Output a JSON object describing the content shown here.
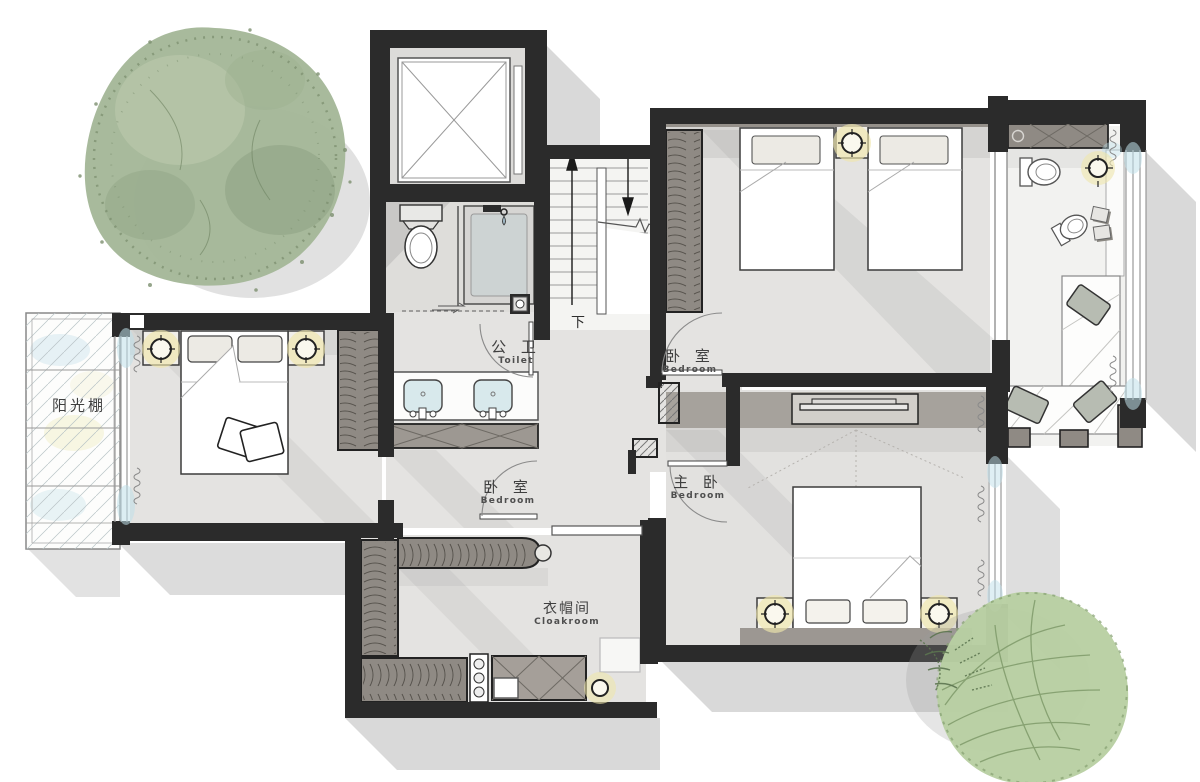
{
  "labels": {
    "sunroom": {
      "zh": "阳光棚"
    },
    "toilet": {
      "zh": "公 卫",
      "en": "Toilet"
    },
    "bedroom_top": {
      "zh": "卧 室",
      "en": "Bedroom"
    },
    "bedroom_left": {
      "zh": "卧 室",
      "en": "Bedroom"
    },
    "master_bedroom": {
      "zh": "主 卧",
      "en": "Bedroom"
    },
    "cloakroom": {
      "zh": "衣帽间",
      "en": "Cloakroom"
    },
    "stairs_down": "下"
  },
  "colors": {
    "wall_dark": "#2b2b2b",
    "wall_gray": "#8f8a84",
    "floor": "#e4e3e1",
    "floor_light": "#f2f2f0",
    "glass_blue": "#bfe0ea",
    "lamp_glow": "#efe6ac",
    "shadow": "#8a8a8a",
    "tree_top": "#a4b798",
    "tree_bottom": "#b8cfa2"
  }
}
